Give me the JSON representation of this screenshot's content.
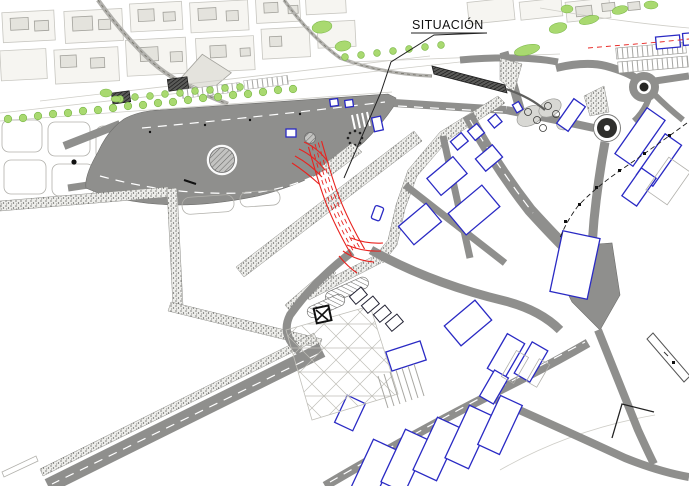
{
  "label": {
    "text": "SITUACIÓN"
  },
  "palette": {
    "road_gray": "#8f8f8d",
    "road_edge": "#6d6d6b",
    "highlight_red": "#e8231f",
    "building_blue": "#2a2ac4",
    "tree_green": "#a9d970",
    "tree_edge": "#77b544",
    "block_fill": "#f6f5f1",
    "block_stroke": "#c7c6c0",
    "detail_dark": "#1f1f1e",
    "faint_line": "#cfcec8"
  }
}
